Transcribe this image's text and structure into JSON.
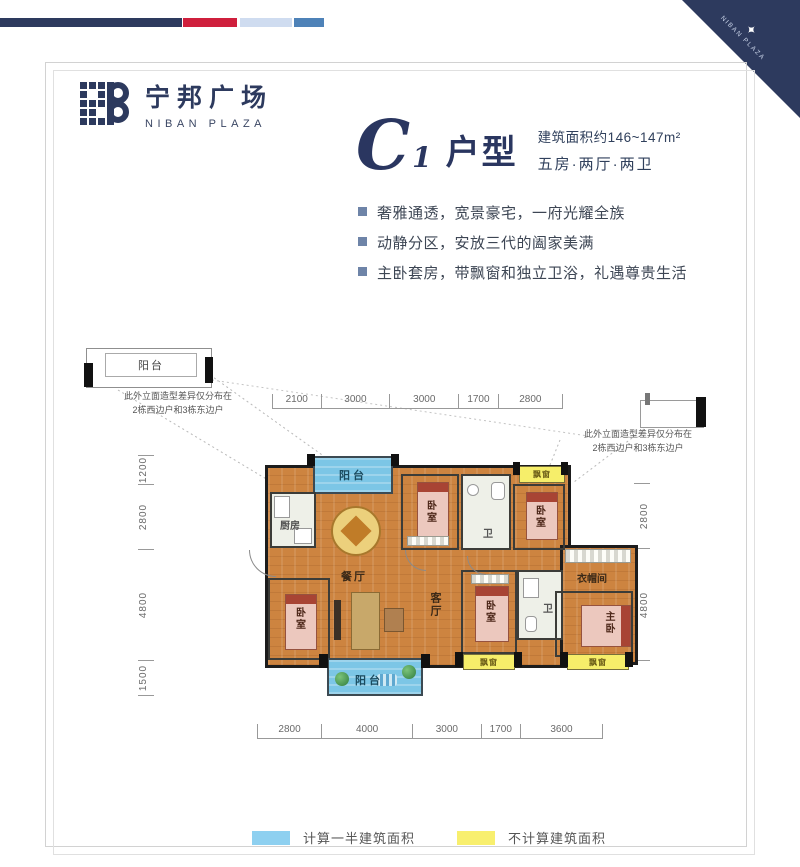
{
  "brand": {
    "logo_cn": "宁邦广场",
    "logo_en": "NIBAN PLAZA",
    "corner_text": "NIBAN PLAZA"
  },
  "title": {
    "unit_letter": "C",
    "unit_number": "1",
    "unit_suffix": "户型",
    "area": "建筑面积约146~147m²",
    "config": "五房·两厅·两卫"
  },
  "features": [
    "奢雅通透，宽景豪宅，一府光耀全族",
    "动静分区，安放三代的阖家美满",
    "主卧套房，带飘窗和独立卫浴，礼遇尊贵生活"
  ],
  "floorplan": {
    "note_line1": "此外立面造型差异仅分布在",
    "note_line2": "2栋西边户和3栋东边户",
    "detail_label": "阳台",
    "rooms": {
      "balcony_top": "阳台",
      "kitchen": "厨房",
      "dining": "餐厅",
      "bedroom_a": "卧室",
      "bath_a": "卫",
      "baywindow_top": "飘窗",
      "bedroom_b": "卧室",
      "bedroom_c": "卧室",
      "living": "客厅",
      "balcony_bottom": "阳台",
      "bedroom_d": "卧室",
      "bath_b": "卫",
      "closet": "衣帽间",
      "master": "主卧",
      "baywindow_b1": "飘窗",
      "baywindow_b2": "飘窗"
    },
    "dimensions": {
      "top": [
        2100,
        3000,
        3000,
        1700,
        2800
      ],
      "bottom": [
        2800,
        4000,
        3000,
        1700,
        3600
      ],
      "left": [
        1200,
        2800,
        4800,
        1500
      ],
      "right": [
        2800,
        4800
      ]
    }
  },
  "legend": [
    {
      "color": "#8ed0f0",
      "label": "计算一半建筑面积"
    },
    {
      "color": "#f8ef6e",
      "label": "不计算建筑面积"
    }
  ],
  "colors": {
    "brand_navy": "#2d3a5e",
    "accent_red": "#cf1f3c",
    "accent_pale_blue": "#cfdcf0",
    "accent_steel_blue": "#4e82b8",
    "wood_floor": "#cd8440",
    "balcony_blue": "#7cc6e6",
    "baywindow_yellow": "#f6ee6a"
  }
}
